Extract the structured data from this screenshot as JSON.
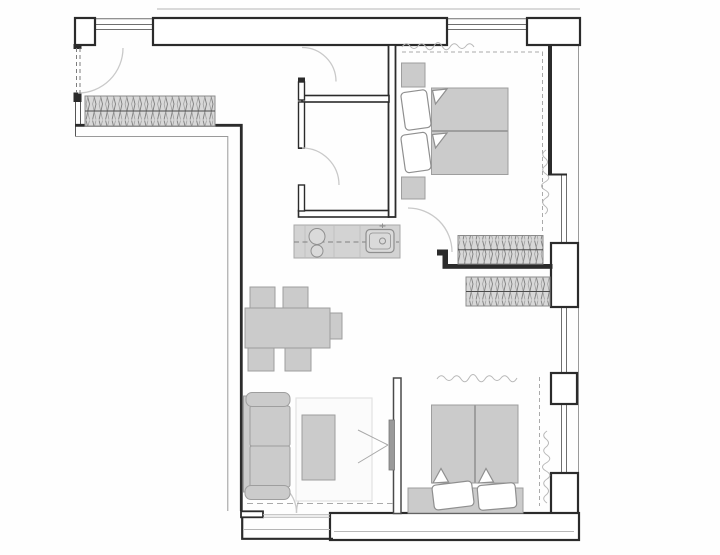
{
  "canvas": {
    "width": 720,
    "height": 555,
    "background": "#fefefe"
  },
  "palette": {
    "wall": "#2b2b2b",
    "wall_fill": "#ffffff",
    "outer_line": "#9a9a9a",
    "roof_line": "#d9d9d9",
    "window_glass": "#6e6e6e",
    "door_arc": "#c9c9c9",
    "door_leaf_dash": "#7d7d7d",
    "dash_line": "#aaaaaa",
    "furniture_fill": "#cbcbcb",
    "furniture_stroke": "#9e9e9e",
    "counter_fill": "#d3d3d3",
    "counter_stroke": "#a8a8a8",
    "appliance_stroke": "#8f8f8f",
    "radiator_fill": "#d8d8d8",
    "radiator_stroke": "#8c8c8c",
    "radiator_hatch": "#7f7f7f",
    "radiator_midline": "#4a4a4a",
    "pillow_fill": "#ffffff",
    "pillow_stroke": "#8f8f8f",
    "rug_fill": "#fbfbfb",
    "rug_stroke": "#e2e2e2",
    "tv_fill": "#9a9a9a",
    "tv_stroke": "#777777",
    "curtain": "#b8b8b8"
  },
  "plan": {
    "type": "apartment-floor-plan",
    "orientation": "top-down",
    "rooms": [
      {
        "id": "entry-hall",
        "features": [
          "entry-door-swing",
          "wall-radiator"
        ]
      },
      {
        "id": "wc",
        "features": [
          "inward-door-swing"
        ]
      },
      {
        "id": "bathroom",
        "features": [
          "inward-door-swing"
        ]
      },
      {
        "id": "kitchen",
        "features": [
          "counter-run",
          "cooktop-two-burners",
          "sink-with-faucet",
          "worktop-centerline-dashed"
        ]
      },
      {
        "id": "living-dining",
        "features": [
          "sofa-two-seat",
          "coffee-table",
          "rug",
          "wall-tv-with-view-lines",
          "dining-table",
          "five-chairs",
          "balcony-double-door",
          "radiator"
        ]
      },
      {
        "id": "bedroom-1",
        "features": [
          "double-bed",
          "two-pillows",
          "two-nightstands",
          "radiator",
          "curtain-squiggle",
          "curtain-rail-dashed",
          "door-swing"
        ]
      },
      {
        "id": "bedroom-2",
        "features": [
          "double-bed",
          "two-pillows",
          "headboard-bench",
          "curtain-squiggle",
          "curtain-rail-dashed",
          "open-doorway",
          "stud-partition-wall"
        ]
      }
    ],
    "window_count": 5,
    "door_swing_count": 6,
    "radiator_count": 3
  }
}
